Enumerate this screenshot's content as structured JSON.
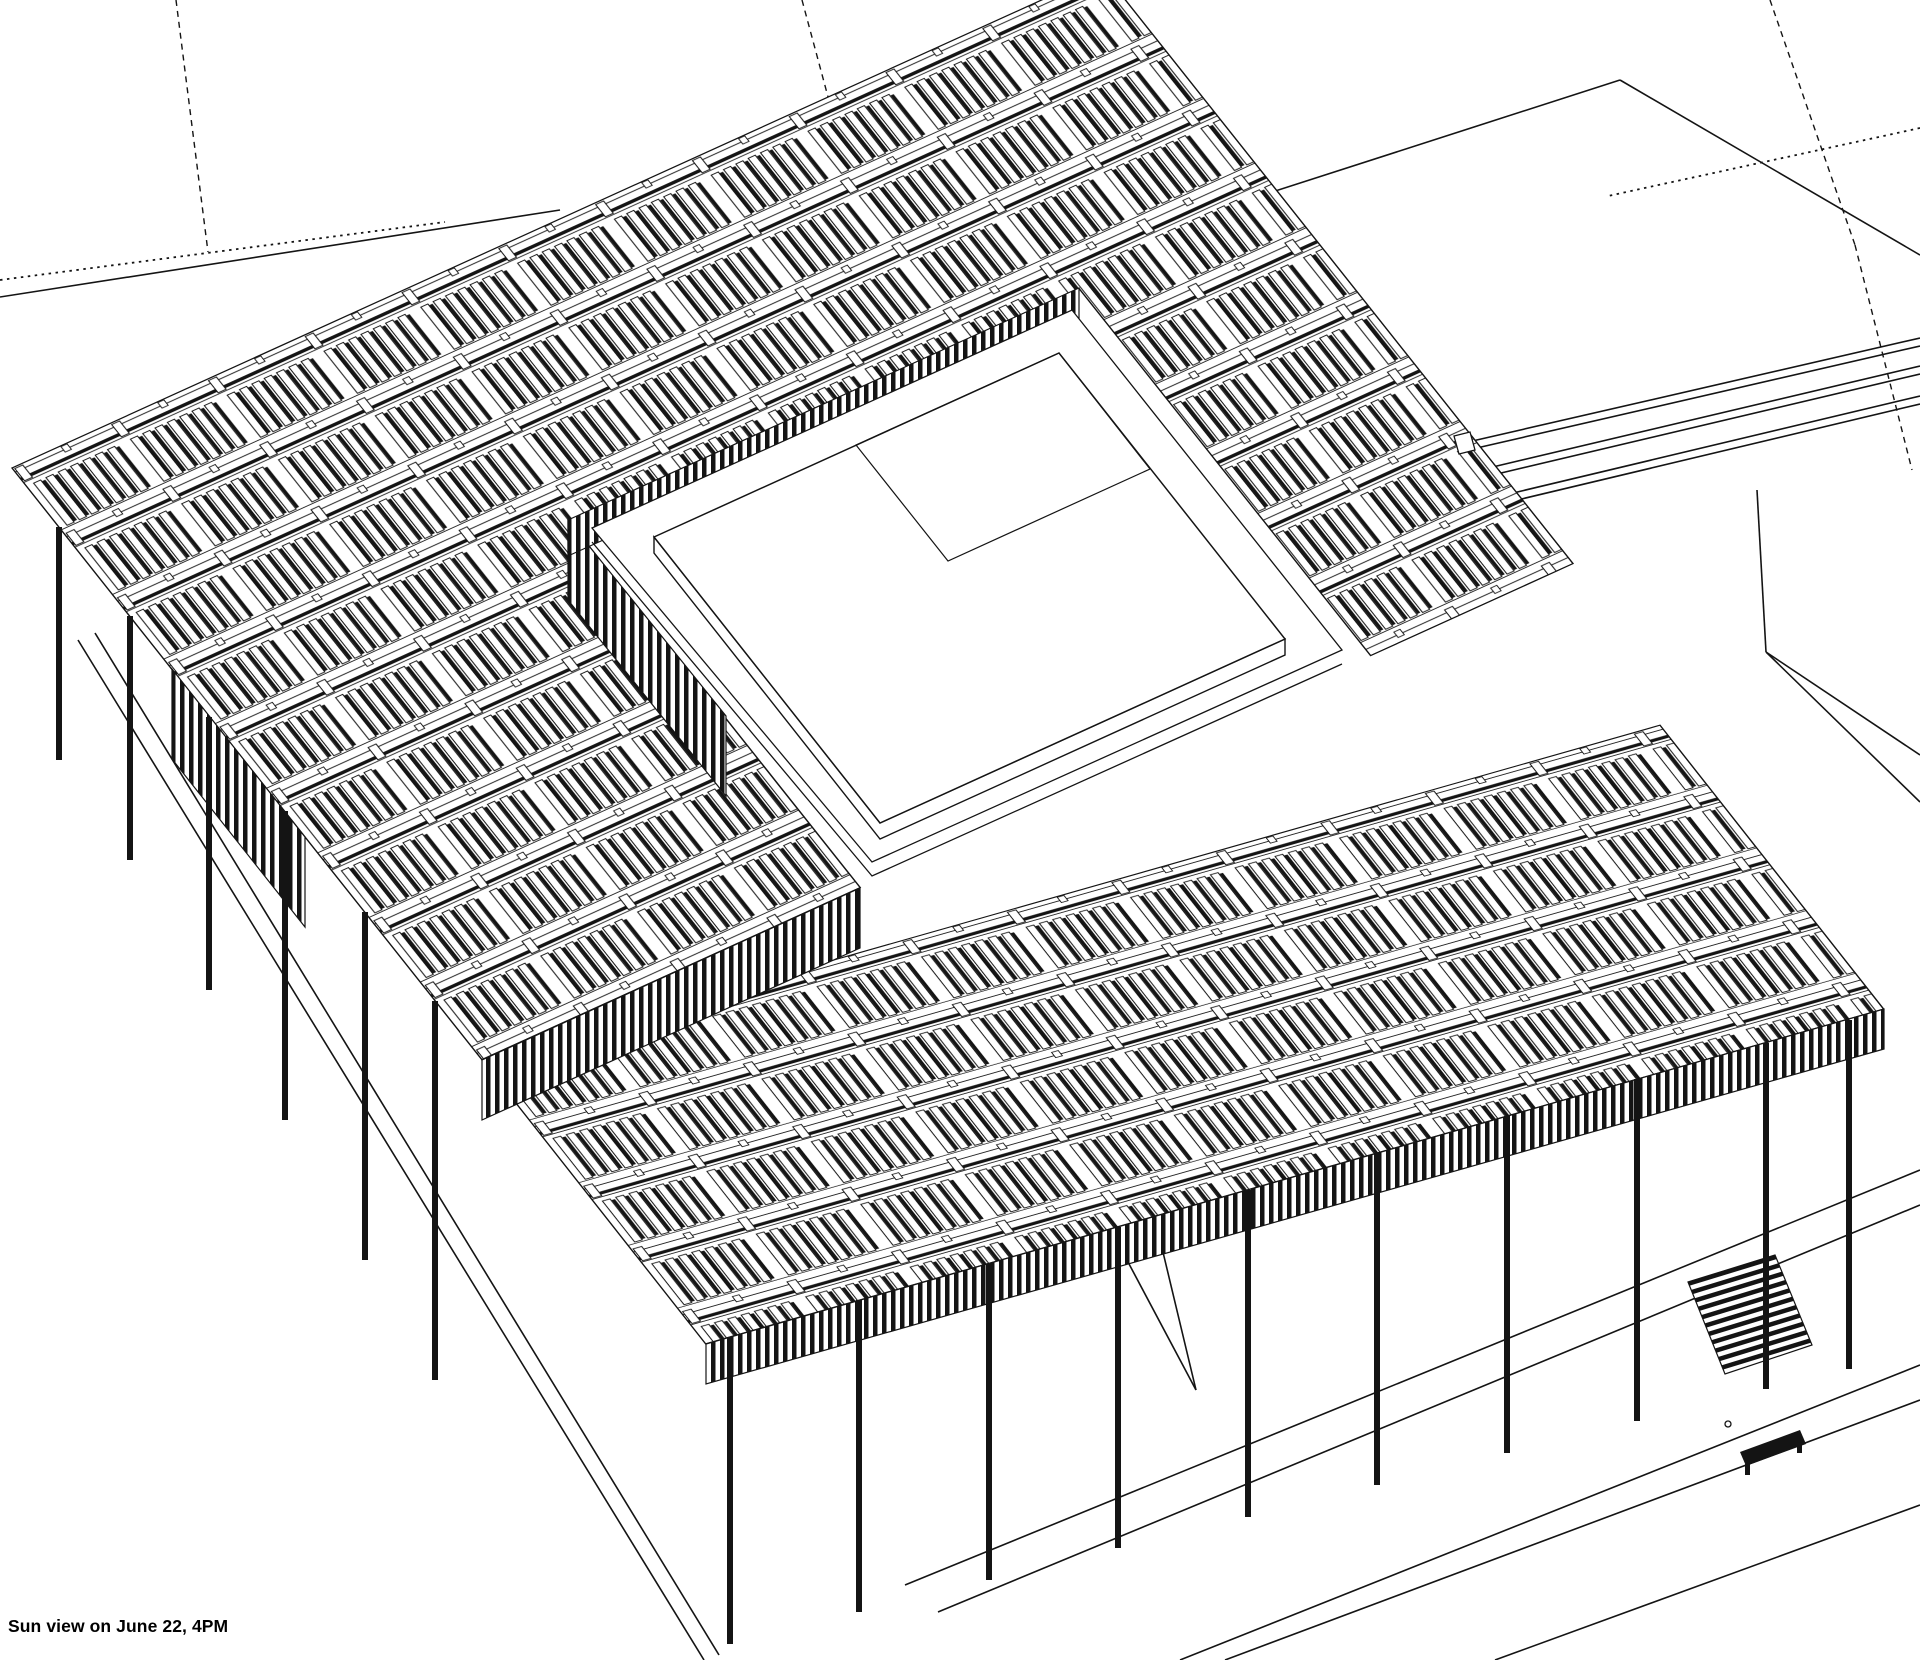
{
  "caption": {
    "text": "Sun view on June 22, 4PM"
  },
  "colors": {
    "background": "#ffffff",
    "line": "#141414"
  },
  "scene": {
    "columns": [
      [
        59,
        527,
        760
      ],
      [
        130,
        616,
        860
      ],
      [
        209,
        717,
        990
      ],
      [
        285,
        811,
        1120
      ],
      [
        365,
        912,
        1260
      ],
      [
        435,
        1001,
        1380
      ],
      [
        730,
        1337,
        1644
      ],
      [
        859,
        1300,
        1612
      ],
      [
        989,
        1264,
        1580
      ],
      [
        1118,
        1227,
        1548
      ],
      [
        1248,
        1190,
        1517
      ],
      [
        1377,
        1153,
        1485
      ],
      [
        1507,
        1116,
        1453
      ],
      [
        1637,
        1079,
        1421
      ],
      [
        1766,
        1043,
        1389
      ],
      [
        1849,
        1020,
        1369
      ]
    ],
    "solid_lines": [
      [
        0,
        297,
        560,
        210
      ],
      [
        1468,
        442,
        1920,
        338
      ],
      [
        1468,
        450,
        1920,
        346
      ],
      [
        1480,
        470,
        1920,
        366
      ],
      [
        1480,
        478,
        1920,
        374
      ],
      [
        1492,
        498,
        1920,
        396
      ],
      [
        1492,
        506,
        1920,
        404
      ],
      [
        1620,
        80,
        1092,
        250
      ],
      [
        1620,
        80,
        1920,
        255
      ],
      [
        1757,
        490,
        1766,
        652
      ],
      [
        1766,
        652,
        1920,
        755
      ],
      [
        1766,
        652,
        1920,
        802
      ],
      [
        78,
        640,
        704,
        1660
      ],
      [
        95,
        633,
        719,
        1655
      ],
      [
        905,
        1585,
        1920,
        1170
      ],
      [
        938,
        1612,
        1920,
        1205
      ],
      [
        1180,
        1660,
        1920,
        1365
      ],
      [
        1225,
        1660,
        1920,
        1400
      ],
      [
        1495,
        1660,
        1920,
        1505
      ],
      [
        1128,
        1262,
        1196,
        1390
      ],
      [
        1196,
        1390,
        1162,
        1248
      ]
    ],
    "dashed_lines": [
      [
        176,
        0,
        208,
        252
      ],
      [
        802,
        0,
        831,
        108
      ],
      [
        1770,
        0,
        1855,
        245
      ],
      [
        1855,
        245,
        1912,
        470
      ]
    ],
    "dotted_lines": [
      [
        1920,
        128,
        1608,
        196
      ],
      [
        0,
        280,
        445,
        222
      ]
    ]
  }
}
